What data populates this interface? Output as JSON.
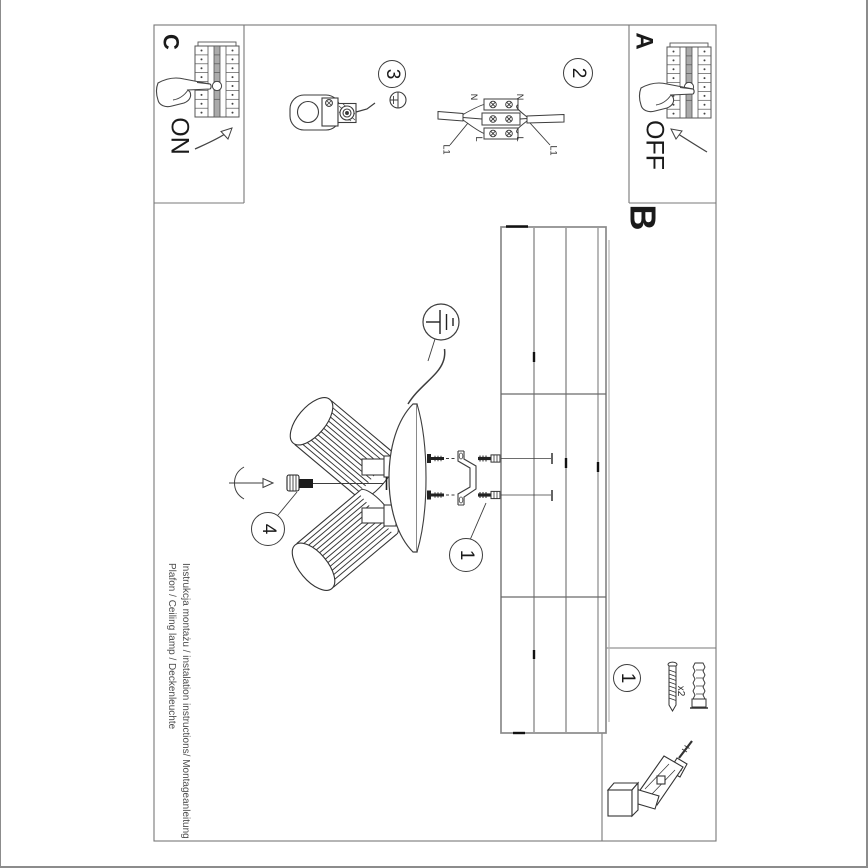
{
  "footer": {
    "line1": "Instrukcja montażu / instalation instructions/ Montageanleitung",
    "line2": "Plafon / Ceiling lamp / Deckenleuchte"
  },
  "sections": {
    "c": {
      "label": "C",
      "action": "ON"
    },
    "a": {
      "label": "A",
      "action": "OFF"
    },
    "b": {
      "label": "B"
    }
  },
  "steps": {
    "step1": "1",
    "step2": "2",
    "step3": "3",
    "step4": "4",
    "step1_parts_box": "1"
  },
  "wiring_labels": {
    "n_left": "N",
    "n_right": "N",
    "l_left": "L",
    "l_right": "L",
    "l1_left": "L1",
    "l1_right": "L1"
  },
  "parts": {
    "anchor_quantity": "x2"
  },
  "colors": {
    "line": "#3d3d3d",
    "soft_line": "#8a8a8a",
    "frame": "#8c8c8c",
    "text": "#1a1a1a",
    "footer_text": "#4d4d4d"
  }
}
